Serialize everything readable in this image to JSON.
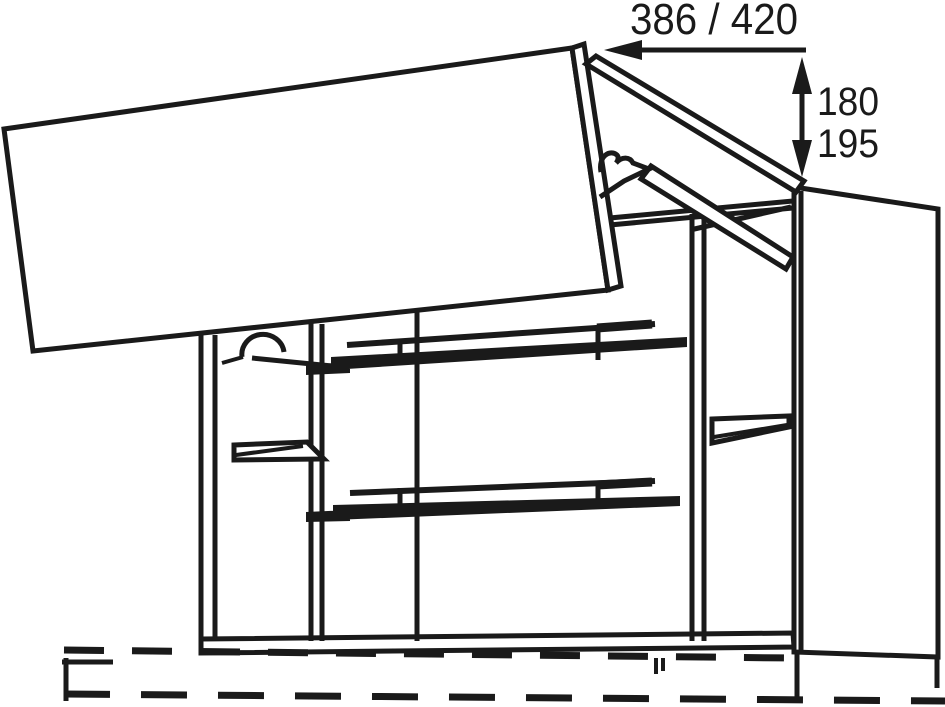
{
  "diagram_type": "furniture-technical-drawing",
  "dimensions": {
    "width": {
      "label": "386 / 420"
    },
    "height": {
      "values": [
        "180",
        "195"
      ]
    }
  },
  "colors": {
    "line": "#1a1a1a",
    "background": "#ffffff",
    "shelf_fill": "#1a1a1a"
  },
  "parts": {
    "door": "open-flap-door",
    "upper_door_panel": "folded-upper-door-panel",
    "hinge": "folding-hinge-fitting",
    "carcass": "cabinet-carcass",
    "shelves": [
      "glass-shelf-upper",
      "glass-shelf-lower",
      "side-shelf-left",
      "side-shelf-right"
    ],
    "side_panel": "right-side-panel",
    "wall": "wall-dashed-reference-lines"
  }
}
